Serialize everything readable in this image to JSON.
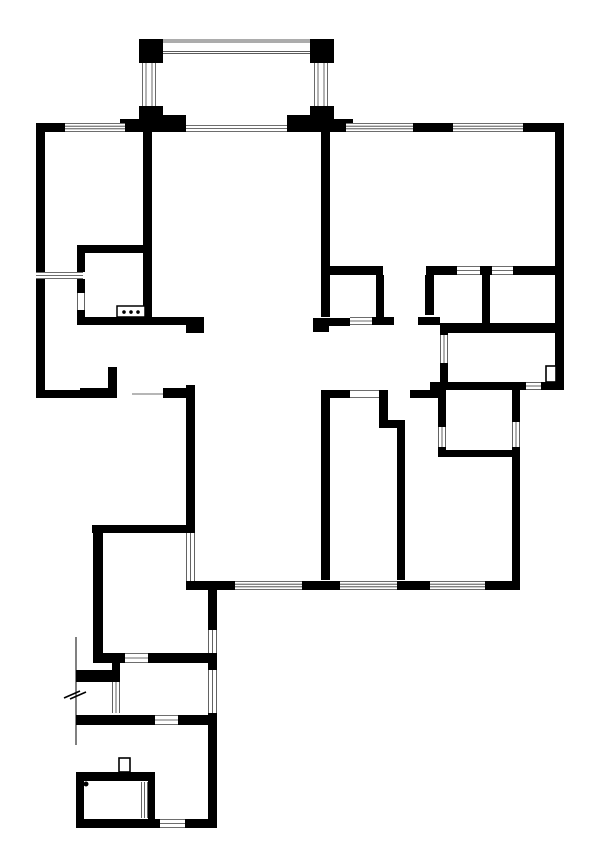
{
  "document": {
    "type": "architectural-floor-plan",
    "canvas": {
      "width": 600,
      "height": 867,
      "background": "#ffffff"
    }
  },
  "style": {
    "wall_color": "#000000",
    "window_line_color": "#3c3c3c",
    "railing_line_color": "#5a5a5a",
    "fixture_stroke_color": "#000000",
    "window_line_width": 0.8,
    "railing_line_width": 0.9
  },
  "plan": {
    "walls": [
      [
        139,
        39,
        24,
        24
      ],
      [
        310,
        39,
        24,
        24
      ],
      [
        139,
        106,
        24,
        17
      ],
      [
        163,
        115,
        23,
        8
      ],
      [
        310,
        106,
        24,
        17
      ],
      [
        287,
        115,
        23,
        8
      ],
      [
        120,
        119,
        19,
        6
      ],
      [
        334,
        119,
        19,
        6
      ],
      [
        36,
        123,
        29,
        9
      ],
      [
        125,
        123,
        61,
        9
      ],
      [
        287,
        123,
        59,
        9
      ],
      [
        413,
        123,
        40,
        9
      ],
      [
        523,
        123,
        41,
        9
      ],
      [
        36,
        123,
        9,
        149
      ],
      [
        36,
        279,
        9,
        111
      ],
      [
        555,
        123,
        9,
        267
      ],
      [
        36,
        390,
        81,
        8
      ],
      [
        108,
        367,
        9,
        23
      ],
      [
        80,
        388,
        37,
        10
      ],
      [
        163,
        388,
        32,
        10
      ],
      [
        143,
        132,
        9,
        191
      ],
      [
        321,
        123,
        9,
        194
      ],
      [
        77,
        245,
        68,
        8
      ],
      [
        77,
        253,
        8,
        19
      ],
      [
        77,
        279,
        8,
        14
      ],
      [
        77,
        310,
        8,
        7
      ],
      [
        77,
        317,
        109,
        8
      ],
      [
        186,
        317,
        18,
        16
      ],
      [
        330,
        266,
        53,
        9
      ],
      [
        426,
        266,
        31,
        9
      ],
      [
        480,
        266,
        12,
        9
      ],
      [
        513,
        266,
        42,
        9
      ],
      [
        376,
        275,
        8,
        42
      ],
      [
        313,
        318,
        16,
        14
      ],
      [
        313,
        318,
        37,
        8
      ],
      [
        372,
        317,
        22,
        8
      ],
      [
        418,
        317,
        22,
        8
      ],
      [
        425,
        275,
        9,
        40
      ],
      [
        482,
        275,
        8,
        48
      ],
      [
        443,
        323,
        120,
        10
      ],
      [
        440,
        323,
        8,
        12
      ],
      [
        440,
        363,
        8,
        27
      ],
      [
        430,
        382,
        96,
        8
      ],
      [
        541,
        382,
        23,
        8
      ],
      [
        321,
        390,
        29,
        8
      ],
      [
        379,
        390,
        9,
        38
      ],
      [
        379,
        420,
        26,
        8
      ],
      [
        397,
        423,
        8,
        157
      ],
      [
        321,
        390,
        9,
        190
      ],
      [
        410,
        390,
        28,
        8
      ],
      [
        438,
        388,
        8,
        39
      ],
      [
        438,
        447,
        8,
        10
      ],
      [
        438,
        450,
        82,
        7
      ],
      [
        512,
        390,
        8,
        32
      ],
      [
        512,
        447,
        8,
        143
      ],
      [
        187,
        581,
        48,
        9
      ],
      [
        302,
        581,
        38,
        9
      ],
      [
        397,
        581,
        33,
        9
      ],
      [
        485,
        581,
        33,
        9
      ],
      [
        186,
        581,
        26,
        9
      ],
      [
        186,
        385,
        9,
        148
      ],
      [
        92,
        525,
        98,
        8
      ],
      [
        93,
        525,
        10,
        137
      ],
      [
        93,
        653,
        32,
        10
      ],
      [
        148,
        653,
        60,
        10
      ],
      [
        208,
        653,
        9,
        17
      ],
      [
        208,
        590,
        9,
        40
      ],
      [
        208,
        713,
        9,
        115
      ],
      [
        76,
        670,
        44,
        12
      ],
      [
        112,
        662,
        8,
        20
      ],
      [
        76,
        715,
        44,
        10
      ],
      [
        120,
        715,
        35,
        10
      ],
      [
        178,
        715,
        39,
        10
      ],
      [
        76,
        772,
        74,
        9
      ],
      [
        76,
        772,
        8,
        56
      ],
      [
        76,
        819,
        84,
        9
      ],
      [
        185,
        819,
        32,
        9
      ],
      [
        148,
        772,
        7,
        48
      ]
    ],
    "windows": [
      [
        65,
        123,
        60,
        9,
        "h",
        4
      ],
      [
        186,
        125,
        101,
        7,
        "h",
        3
      ],
      [
        346,
        123,
        67,
        9,
        "h",
        4
      ],
      [
        453,
        123,
        70,
        9,
        "h",
        4
      ],
      [
        36,
        272,
        47,
        7,
        "h",
        3
      ],
      [
        77,
        293,
        8,
        17,
        "v",
        2
      ],
      [
        457,
        266,
        23,
        9,
        "h",
        3
      ],
      [
        492,
        266,
        21,
        9,
        "h",
        3
      ],
      [
        350,
        317,
        22,
        8,
        "h",
        3
      ],
      [
        440,
        335,
        8,
        28,
        "v",
        3
      ],
      [
        526,
        382,
        15,
        8,
        "h",
        3
      ],
      [
        350,
        390,
        29,
        8,
        "h",
        2
      ],
      [
        132,
        390,
        31,
        8,
        "h",
        1
      ],
      [
        438,
        427,
        8,
        20,
        "v",
        3
      ],
      [
        512,
        422,
        8,
        25,
        "v",
        3
      ],
      [
        235,
        581,
        67,
        9,
        "h",
        4
      ],
      [
        340,
        581,
        57,
        9,
        "h",
        4
      ],
      [
        430,
        581,
        55,
        9,
        "h",
        4
      ],
      [
        186,
        533,
        9,
        48,
        "v",
        3
      ],
      [
        208,
        630,
        9,
        23,
        "v",
        3
      ],
      [
        208,
        670,
        9,
        43,
        "v",
        3
      ],
      [
        125,
        653,
        23,
        10,
        "h",
        3
      ],
      [
        155,
        715,
        23,
        10,
        "h",
        3
      ],
      [
        112,
        682,
        8,
        31,
        "v",
        3
      ],
      [
        141,
        782,
        7,
        36,
        "v",
        3
      ],
      [
        160,
        819,
        25,
        9,
        "h",
        3
      ]
    ],
    "railings": {
      "top": {
        "x1": 163,
        "x2": 310,
        "ys": [
          40,
          42,
          51.5,
          53.5
        ]
      },
      "left": {
        "y1": 63,
        "y2": 106,
        "xs": [
          142.5,
          146,
          152,
          155.5
        ]
      },
      "right": {
        "y1": 63,
        "y2": 106,
        "xs": [
          314.5,
          318,
          324,
          327.5
        ]
      }
    },
    "fixtures": {
      "stove": {
        "x": 117,
        "y": 306,
        "w": 28,
        "h": 11,
        "dots": 3,
        "dot_r": 1.8
      },
      "door_leaf_bathroom": {
        "x": 546,
        "y": 366,
        "w": 10,
        "h": 16
      },
      "door_jamb_entry": {
        "x": 119,
        "y": 758,
        "w": 11,
        "h": 14
      },
      "drain_dot": {
        "cx": 86,
        "cy": 784,
        "r": 2.5
      },
      "fence_line": {
        "x": 76,
        "y1": 637,
        "y2": 745,
        "break_marks": [
          [
            64,
            698,
            80,
            691
          ],
          [
            70,
            699,
            86,
            692
          ]
        ]
      }
    }
  }
}
